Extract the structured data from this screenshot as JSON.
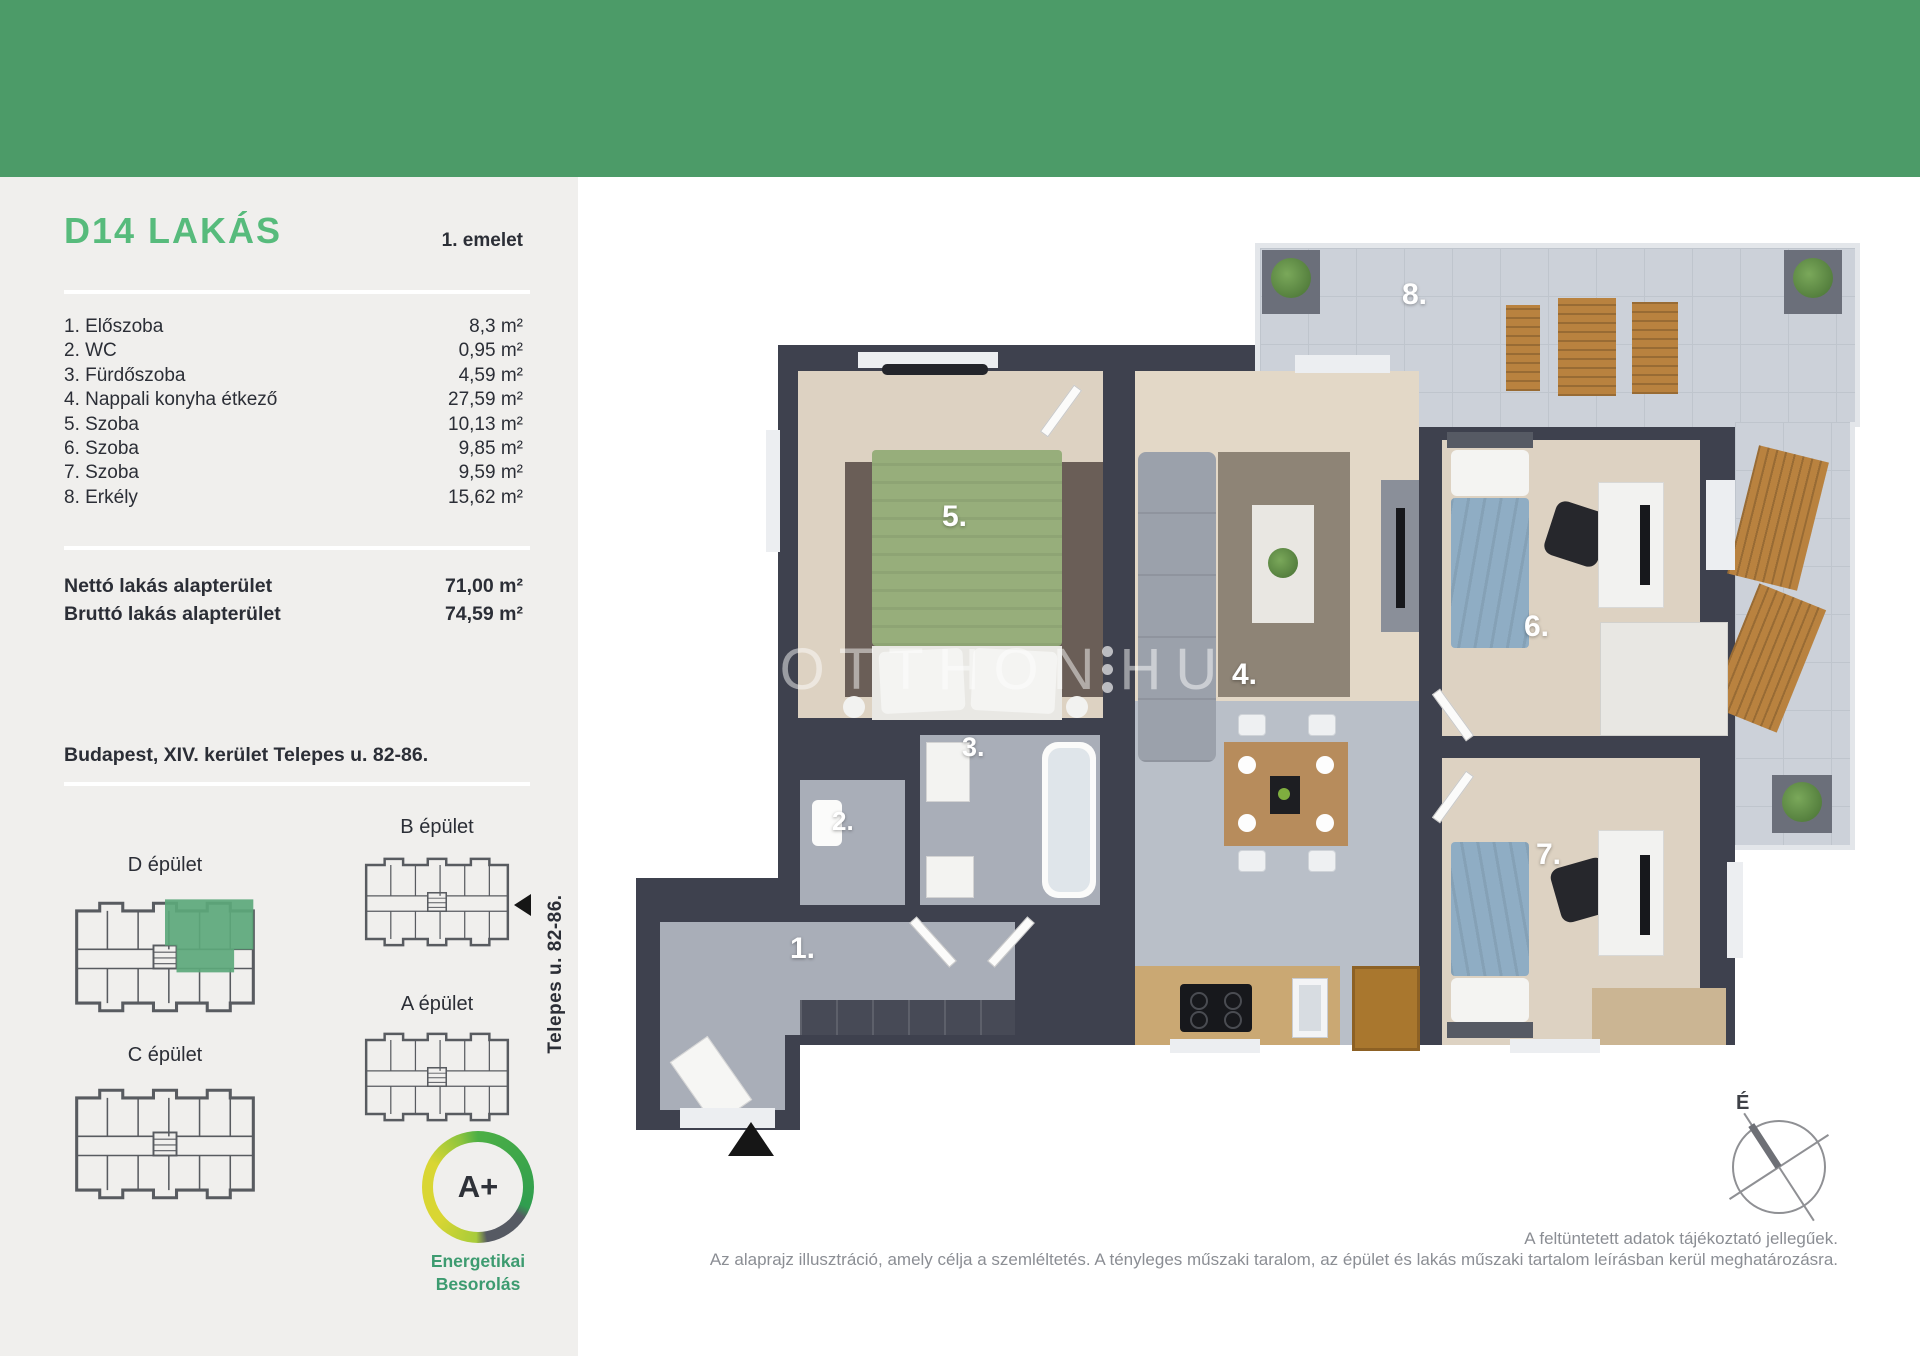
{
  "colors": {
    "header_green": "#4c9b68",
    "title_green": "#57bb7c",
    "sidebar_bg": "#f0efed",
    "wall_dark": "#3e414e",
    "energy_label_green": "#3d9b70"
  },
  "sidebar": {
    "title": "D14 LAKÁS",
    "floor": "1. emelet",
    "rooms": [
      {
        "label": "1. Előszoba",
        "area": "8,3 m²"
      },
      {
        "label": "2. WC",
        "area": "0,95 m²"
      },
      {
        "label": "3. Fürdőszoba",
        "area": "4,59 m²"
      },
      {
        "label": "4. Nappali konyha étkező",
        "area": "27,59 m²"
      },
      {
        "label": "5. Szoba",
        "area": "10,13 m²"
      },
      {
        "label": "6. Szoba",
        "area": "9,85 m²"
      },
      {
        "label": "7. Szoba",
        "area": "9,59 m²"
      },
      {
        "label": "8. Erkély",
        "area": "15,62 m²"
      }
    ],
    "totals": [
      {
        "label": "Nettó lakás alapterület",
        "value": "71,00 m²"
      },
      {
        "label": "Bruttó lakás alapterület",
        "value": "74,59 m²"
      }
    ],
    "address": "Budapest, XIV. kerület Telepes u. 82-86.",
    "buildings": {
      "d": "D épület",
      "b": "B épület",
      "c": "C épület",
      "a": "A épület"
    },
    "street_label": "Telepes u. 82-86.",
    "energy": {
      "rating": "A+",
      "line1": "Energetikai",
      "line2": "Besorolás"
    }
  },
  "plan": {
    "room_numbers": [
      "1.",
      "2.",
      "3.",
      "4.",
      "5.",
      "6.",
      "7.",
      "8."
    ],
    "watermark": {
      "part1": "UJOTTHON",
      "part2": "HU"
    },
    "compass_label": "É"
  },
  "footer": {
    "note1": "A feltüntetett adatok tájékoztató jellegűek.",
    "note2": "Az alaprajz illusztráció, amely célja a szemléltetés. A tényleges műszaki taralom, az épület és lakás műszaki tartalom leírásban kerül meghatározásra."
  }
}
